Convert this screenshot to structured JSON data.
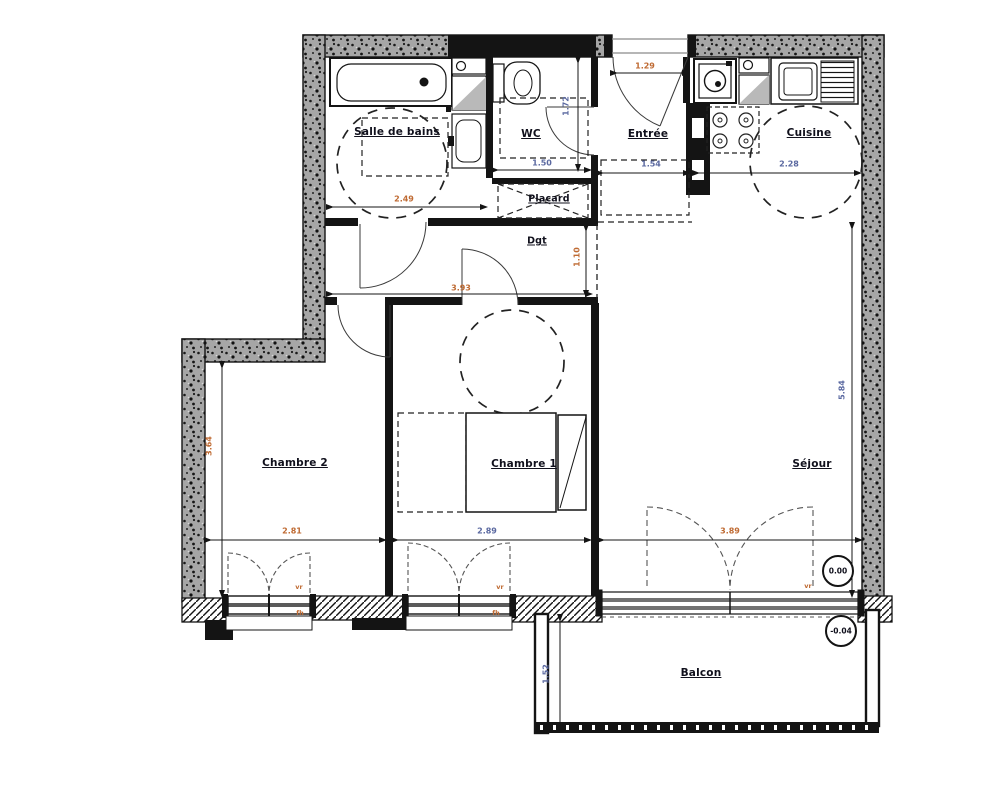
{
  "page": {
    "type": "architectural-floor-plan",
    "language": "fr"
  },
  "colors": {
    "background": "#ffffff",
    "wall_gray": "#a6a6a6",
    "line_black": "#141414",
    "dim_blue": "#5a68a0",
    "dim_orange": "#bf6a32",
    "label": "#10101c",
    "fixture_gray": "#b9b9b9"
  },
  "rooms": [
    {
      "name": "Salle de bains"
    },
    {
      "name": "WC"
    },
    {
      "name": "Entrée"
    },
    {
      "name": "Cuisine"
    },
    {
      "name": "Placard"
    },
    {
      "name": "Dgt"
    },
    {
      "name": "Chambre 2"
    },
    {
      "name": "Chambre 1"
    },
    {
      "name": "Séjour"
    },
    {
      "name": "Balcon"
    }
  ],
  "dims_h": [
    {
      "value": "1.29"
    },
    {
      "value": "1.50"
    },
    {
      "value": "1.54"
    },
    {
      "value": "2.28"
    },
    {
      "value": "2.49"
    },
    {
      "value": "3.93"
    },
    {
      "value": "2.81"
    },
    {
      "value": "2.89"
    },
    {
      "value": "3.89"
    }
  ],
  "dims_v": [
    {
      "value": "1.72"
    },
    {
      "value": "1.10"
    },
    {
      "value": "3.64"
    },
    {
      "value": "5.84"
    },
    {
      "value": "1.52"
    }
  ],
  "levels": [
    {
      "value": "0.00"
    },
    {
      "value": "-0.04"
    }
  ],
  "window_labels": [
    {
      "value": "vr"
    },
    {
      "value": "fh"
    },
    {
      "value": "vr"
    },
    {
      "value": "fh"
    },
    {
      "value": "vr"
    }
  ],
  "fixtures": [
    "bathtub-icon",
    "washbasin-icon",
    "toilet-icon",
    "washing-machine-icon",
    "kitchen-sink-icon",
    "drainer-icon",
    "cooktop-icon",
    "bed-icon",
    "wardrobe-icon",
    "closet-cross-icon",
    "turning-circle-icon",
    "door-swing-icon",
    "window-icon",
    "sliding-bay-icon",
    "level-marker-icon",
    "balcony-railing-icon",
    "technical-duct-icon"
  ]
}
